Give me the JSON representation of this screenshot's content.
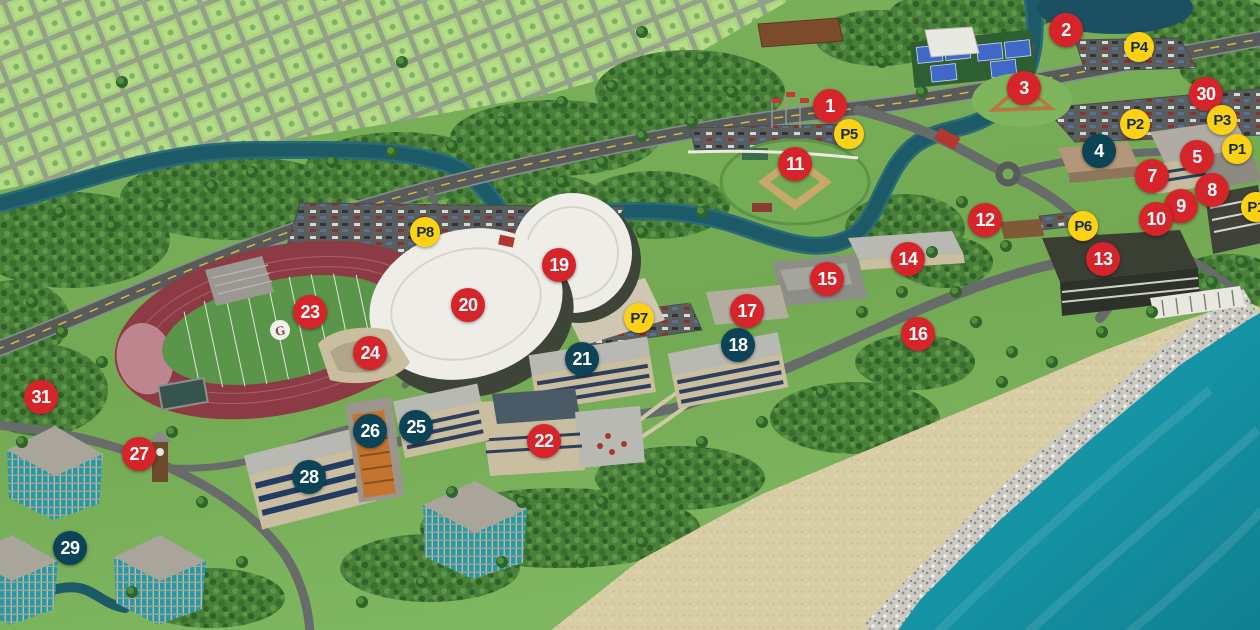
{
  "map": {
    "field_logo": "G"
  },
  "marker_styles": {
    "red": {
      "bg": "#d6242b",
      "text": "#ffffff"
    },
    "navy": {
      "bg": "#0d4356",
      "text": "#ffffff"
    },
    "yellow": {
      "bg": "#fdd215",
      "text": "#132c36"
    }
  },
  "palette": {
    "grass": "#74aa55",
    "forest": "#477d36",
    "neighborhood": "#a9d37e",
    "river": "#1d5a68",
    "ocean": "#1593a4",
    "sand": "#d8cda4",
    "rocks": "#cccbc5",
    "road": "#5b605e",
    "track": "#8c3a44",
    "arena_roof": "#eeede8"
  },
  "markers": [
    {
      "label": "1",
      "type": "red",
      "x": 830,
      "y": 106
    },
    {
      "label": "2",
      "type": "red",
      "x": 1066,
      "y": 30
    },
    {
      "label": "3",
      "type": "red",
      "x": 1024,
      "y": 88
    },
    {
      "label": "4",
      "type": "navy",
      "x": 1099,
      "y": 151
    },
    {
      "label": "5",
      "type": "red",
      "x": 1197,
      "y": 157
    },
    {
      "label": "7",
      "type": "red",
      "x": 1152,
      "y": 176
    },
    {
      "label": "8",
      "type": "red",
      "x": 1212,
      "y": 190
    },
    {
      "label": "9",
      "type": "red",
      "x": 1181,
      "y": 206
    },
    {
      "label": "10",
      "type": "red",
      "x": 1156,
      "y": 219
    },
    {
      "label": "11",
      "type": "red",
      "x": 795,
      "y": 164
    },
    {
      "label": "12",
      "type": "red",
      "x": 985,
      "y": 220
    },
    {
      "label": "13",
      "type": "red",
      "x": 1103,
      "y": 259
    },
    {
      "label": "14",
      "type": "red",
      "x": 908,
      "y": 259
    },
    {
      "label": "15",
      "type": "red",
      "x": 827,
      "y": 279
    },
    {
      "label": "16",
      "type": "red",
      "x": 918,
      "y": 334
    },
    {
      "label": "17",
      "type": "red",
      "x": 747,
      "y": 311
    },
    {
      "label": "18",
      "type": "navy",
      "x": 738,
      "y": 345
    },
    {
      "label": "19",
      "type": "red",
      "x": 559,
      "y": 265
    },
    {
      "label": "20",
      "type": "red",
      "x": 468,
      "y": 305
    },
    {
      "label": "21",
      "type": "navy",
      "x": 582,
      "y": 359
    },
    {
      "label": "22",
      "type": "red",
      "x": 544,
      "y": 441
    },
    {
      "label": "23",
      "type": "red",
      "x": 310,
      "y": 312
    },
    {
      "label": "24",
      "type": "red",
      "x": 370,
      "y": 353
    },
    {
      "label": "25",
      "type": "navy",
      "x": 416,
      "y": 427
    },
    {
      "label": "26",
      "type": "navy",
      "x": 370,
      "y": 431
    },
    {
      "label": "27",
      "type": "red",
      "x": 139,
      "y": 454
    },
    {
      "label": "28",
      "type": "navy",
      "x": 309,
      "y": 477
    },
    {
      "label": "29",
      "type": "navy",
      "x": 70,
      "y": 548
    },
    {
      "label": "30",
      "type": "red",
      "x": 1206,
      "y": 94
    },
    {
      "label": "31",
      "type": "red",
      "x": 41,
      "y": 397
    },
    {
      "label": "P1",
      "type": "yellow",
      "x": 1237,
      "y": 149
    },
    {
      "label": "P1",
      "key": "P1b",
      "type": "yellow",
      "x": 1256,
      "y": 207
    },
    {
      "label": "P2",
      "type": "yellow",
      "x": 1135,
      "y": 124
    },
    {
      "label": "P3",
      "type": "yellow",
      "x": 1222,
      "y": 120
    },
    {
      "label": "P4",
      "type": "yellow",
      "x": 1139,
      "y": 47
    },
    {
      "label": "P5",
      "type": "yellow",
      "x": 849,
      "y": 134
    },
    {
      "label": "P6",
      "type": "yellow",
      "x": 1083,
      "y": 226
    },
    {
      "label": "P7",
      "type": "yellow",
      "x": 639,
      "y": 318
    },
    {
      "label": "P8",
      "type": "yellow",
      "x": 425,
      "y": 232
    }
  ]
}
